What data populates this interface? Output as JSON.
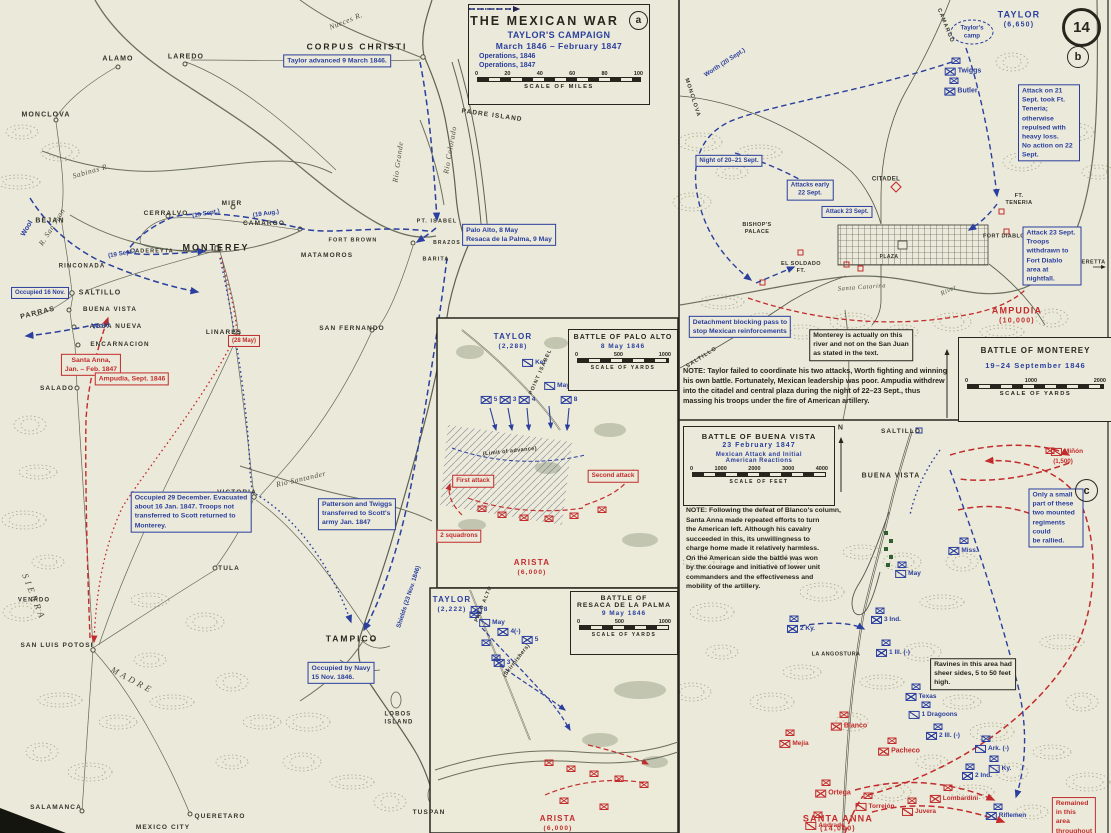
{
  "page": {
    "badge": "14",
    "panel_a_badge": "a",
    "panel_b_badge": "b",
    "panel_c_badge": "c"
  },
  "title_block": {
    "title": "THE MEXICAN WAR",
    "subtitle": "TAYLOR'S CAMPAIGN",
    "dates": "March 1846 – February 1847",
    "legend": [
      {
        "label": "Operations, 1846"
      },
      {
        "label": "Operations, 1847"
      }
    ],
    "scale": {
      "ticks": [
        "0",
        "20",
        "40",
        "60",
        "80",
        "100"
      ],
      "caption": "SCALE OF MILES"
    }
  },
  "battle_boxes": {
    "palo_alto": {
      "title": "BATTLE OF PALO ALTO",
      "date": "8 May 1846",
      "scale": {
        "ticks": [
          "0",
          "500",
          "1000"
        ],
        "caption": "SCALE OF YARDS"
      }
    },
    "resaca": {
      "title": "BATTLE OF\nRESACA DE LA PALMA",
      "date": "9 May 1846",
      "scale": {
        "ticks": [
          "0",
          "500",
          "1000"
        ],
        "caption": "SCALE OF YARDS"
      }
    },
    "monterey": {
      "title": "BATTLE OF MONTEREY",
      "date": "19–24 September 1846",
      "scale": {
        "ticks": [
          "0",
          "1000",
          "2000"
        ],
        "caption": "SCALE OF YARDS"
      }
    },
    "buena_vista": {
      "title": "BATTLE OF BUENA VISTA",
      "date": "23 February 1847",
      "subtitle": "Mexican Attack and Initial\nAmerican Reactions",
      "scale": {
        "ticks": [
          "0",
          "1000",
          "2000",
          "3000",
          "4000"
        ],
        "caption": "SCALE OF FEET"
      }
    }
  },
  "colors": {
    "paper": "#ebe9d9",
    "blue": "#2a3f9e",
    "red": "#c22c2c",
    "ink": "#26261e",
    "terrain": "#a8a58c"
  },
  "labels": [
    {
      "t": "ALAMO",
      "x": 118,
      "y": 60,
      "c": "p",
      "fs": 7
    },
    {
      "t": "LAREDO",
      "x": 186,
      "y": 58,
      "c": "p",
      "fs": 7
    },
    {
      "t": "MONCLOVA",
      "x": 46,
      "y": 116,
      "c": "p",
      "fs": 7
    },
    {
      "t": "BEJAN",
      "x": 50,
      "y": 222,
      "c": "p",
      "fs": 7
    },
    {
      "t": "CERRALVO",
      "x": 166,
      "y": 214,
      "c": "p",
      "fs": 6.5
    },
    {
      "t": "MIER",
      "x": 232,
      "y": 204,
      "c": "p",
      "fs": 6.5
    },
    {
      "t": "CAMARGO",
      "x": 264,
      "y": 224,
      "c": "p",
      "fs": 6.5
    },
    {
      "t": "RINCONADA",
      "x": 82,
      "y": 267,
      "c": "p",
      "fs": 6
    },
    {
      "t": "MONTEREY",
      "x": 216,
      "y": 248,
      "c": "P"
    },
    {
      "t": "SALTILLO",
      "x": 100,
      "y": 294,
      "c": "p",
      "fs": 7
    },
    {
      "t": "BUENA VISTA",
      "x": 110,
      "y": 310,
      "c": "p",
      "fs": 6.3
    },
    {
      "t": "AGUA NUEVA",
      "x": 116,
      "y": 327,
      "c": "p",
      "fs": 6.3
    },
    {
      "t": "ENCARNACION",
      "x": 120,
      "y": 345,
      "c": "p",
      "fs": 6.3
    },
    {
      "t": "PARRAS",
      "x": 38,
      "y": 314,
      "c": "p",
      "fs": 7,
      "r": -14
    },
    {
      "t": "SALADO",
      "x": 57,
      "y": 389,
      "c": "p",
      "fs": 6.5
    },
    {
      "t": "LINARES",
      "x": 224,
      "y": 333,
      "c": "p",
      "fs": 6.5
    },
    {
      "t": "CADEREYTA",
      "x": 152,
      "y": 252,
      "c": "p",
      "fs": 5.5
    },
    {
      "t": "SAN FERNANDO",
      "x": 352,
      "y": 329,
      "c": "p",
      "fs": 6.5
    },
    {
      "t": "VICTORIA",
      "x": 237,
      "y": 493,
      "c": "p",
      "fs": 6.5
    },
    {
      "t": "TULA",
      "x": 229,
      "y": 569,
      "c": "p",
      "fs": 6.5
    },
    {
      "t": "TAMPICO",
      "x": 352,
      "y": 639,
      "c": "P",
      "fs": 8.5
    },
    {
      "t": "SAN LUIS POTOSI",
      "x": 57,
      "y": 646,
      "c": "p",
      "fs": 6.5
    },
    {
      "t": "VENADO",
      "x": 34,
      "y": 601,
      "c": "p",
      "fs": 6
    },
    {
      "t": "SALAMANCA",
      "x": 56,
      "y": 808,
      "c": "p",
      "fs": 6.5
    },
    {
      "t": "QUERETARO",
      "x": 220,
      "y": 817,
      "c": "p",
      "fs": 6.5
    },
    {
      "t": "MEXICO CITY",
      "x": 163,
      "y": 828,
      "c": "p",
      "fs": 6.5
    },
    {
      "t": "LOBOS\nISLAND",
      "x": 399,
      "y": 719,
      "c": "p",
      "fs": 6
    },
    {
      "t": "TUSPAN",
      "x": 429,
      "y": 813,
      "c": "p",
      "fs": 6.5
    },
    {
      "t": "CORPUS CHRISTI",
      "x": 357,
      "y": 47,
      "c": "P",
      "fs": 8.5
    },
    {
      "t": "PADRE ISLAND",
      "x": 492,
      "y": 116,
      "c": "p",
      "fs": 6.5,
      "r": 8
    },
    {
      "t": "PT. ISABEL",
      "x": 437,
      "y": 222,
      "c": "p",
      "fs": 5.5
    },
    {
      "t": "BRAZOS",
      "x": 447,
      "y": 243,
      "c": "p",
      "fs": 5
    },
    {
      "t": "MATAMOROS",
      "x": 327,
      "y": 256,
      "c": "p",
      "fs": 6.5
    },
    {
      "t": "FORT BROWN",
      "x": 353,
      "y": 241,
      "c": "p",
      "fs": 5.5
    },
    {
      "t": "BARITA",
      "x": 436,
      "y": 260,
      "c": "p",
      "fs": 5.5
    },
    {
      "t": "S I E R R A",
      "x": 33,
      "y": 596,
      "c": "rv",
      "fs": 9,
      "r": 68
    },
    {
      "t": "M A D R E",
      "x": 131,
      "y": 680,
      "c": "rv",
      "fs": 9,
      "r": 28
    },
    {
      "t": "Nueces R.",
      "x": 346,
      "y": 21,
      "c": "rv",
      "r": -22
    },
    {
      "t": "Sabinas R.",
      "x": 91,
      "y": 171,
      "c": "rv",
      "r": -16
    },
    {
      "t": "R. San Juan",
      "x": 52,
      "y": 227,
      "c": "rv",
      "r": -58
    },
    {
      "t": "Rio Grande",
      "x": 398,
      "y": 162,
      "c": "rv",
      "r": -82
    },
    {
      "t": "Rio Colorado",
      "x": 450,
      "y": 150,
      "c": "rv",
      "r": -80
    },
    {
      "t": "Rio Santander",
      "x": 301,
      "y": 479,
      "c": "rv",
      "r": -13
    },
    {
      "t": "Santa Catarina",
      "x": 862,
      "y": 288,
      "c": "rv",
      "fs": 6.5,
      "r": -4
    },
    {
      "t": "River",
      "x": 949,
      "y": 291,
      "c": "rv",
      "fs": 6.5,
      "r": -26
    },
    {
      "t": "Wool",
      "x": 28,
      "y": 229,
      "c": "bt",
      "r": -60
    },
    {
      "t": "Wool",
      "x": 101,
      "y": 327,
      "c": "bt",
      "r": -8
    },
    {
      "t": "(15 Sept.)",
      "x": 206,
      "y": 214,
      "c": "bt",
      "fs": 6.2,
      "r": -10
    },
    {
      "t": "(19 Aug.)",
      "x": 266,
      "y": 214,
      "c": "bt",
      "fs": 6.2,
      "r": -8
    },
    {
      "t": "(19 Sept.)",
      "x": 122,
      "y": 254,
      "c": "bt",
      "fs": 6.2,
      "r": -10
    },
    {
      "t": "Shields (23 Nov. 1846)",
      "x": 409,
      "y": 597,
      "c": "bt",
      "fs": 6.2,
      "r": -72
    },
    {
      "t": "Worth (20 Sept.)",
      "x": 725,
      "y": 63,
      "c": "bt",
      "fs": 6.2,
      "r": -33
    },
    {
      "t": "Taylor's\ncamp",
      "x": 972,
      "y": 32,
      "c": "bt",
      "fs": 6.2
    },
    {
      "t": "CAMARGO",
      "x": 945,
      "y": 26,
      "c": "p",
      "fs": 5.5,
      "r": 68
    },
    {
      "t": "MONCLOVA",
      "x": 692,
      "y": 98,
      "c": "p",
      "fs": 5.5,
      "r": 72
    },
    {
      "t": "SALTILLO",
      "x": 702,
      "y": 358,
      "c": "p",
      "fs": 5.5,
      "r": -32
    },
    {
      "t": "TAYLOR",
      "x": 1019,
      "y": 15,
      "c": "bB"
    },
    {
      "t": "(6,650)",
      "x": 1019,
      "y": 26,
      "c": "bB",
      "fs": 7
    },
    {
      "t": "TAYLOR",
      "x": 513,
      "y": 337,
      "c": "bB",
      "fs": 8
    },
    {
      "t": "(2,288)",
      "x": 513,
      "y": 347,
      "c": "bB",
      "fs": 6.5
    },
    {
      "t": "TAYLOR",
      "x": 452,
      "y": 600,
      "c": "bB",
      "fs": 8
    },
    {
      "t": "(2,222)",
      "x": 452,
      "y": 610,
      "c": "bB",
      "fs": 6.5
    },
    {
      "t": "AMPUDIA",
      "x": 1017,
      "y": 311,
      "c": "rB"
    },
    {
      "t": "(10,000)",
      "x": 1017,
      "y": 322,
      "c": "rB",
      "fs": 7
    },
    {
      "t": "ARISTA",
      "x": 532,
      "y": 563,
      "c": "rB",
      "fs": 8
    },
    {
      "t": "(6,000)",
      "x": 532,
      "y": 573,
      "c": "rB",
      "fs": 6.5
    },
    {
      "t": "ARISTA",
      "x": 558,
      "y": 819,
      "c": "rB",
      "fs": 8
    },
    {
      "t": "(6,000)",
      "x": 558,
      "y": 829,
      "c": "rB",
      "fs": 6.5
    },
    {
      "t": "SANTA ANNA",
      "x": 838,
      "y": 819,
      "c": "rB"
    },
    {
      "t": "(14,000)",
      "x": 838,
      "y": 830,
      "c": "rB",
      "fs": 7
    },
    {
      "t": "CITADEL",
      "x": 886,
      "y": 180,
      "c": "tiny"
    },
    {
      "t": "BISHOP'S\nPALACE",
      "x": 757,
      "y": 229,
      "c": "tiny",
      "fs": 5.5
    },
    {
      "t": "EL SOLDADO\nFT.",
      "x": 801,
      "y": 268,
      "c": "tiny",
      "fs": 5.5
    },
    {
      "t": "FT.\nTENERIA",
      "x": 1019,
      "y": 200,
      "c": "tiny",
      "fs": 5.5
    },
    {
      "t": "FORT DIABLO",
      "x": 1004,
      "y": 237,
      "c": "tiny",
      "fs": 5.5
    },
    {
      "t": "PLAZA",
      "x": 889,
      "y": 257,
      "c": "tiny",
      "fs": 5
    },
    {
      "t": "CADERETTA",
      "x": 1087,
      "y": 263,
      "c": "tiny",
      "fs": 5.5
    },
    {
      "t": "SALTILLO",
      "x": 901,
      "y": 432,
      "c": "p",
      "fs": 6.5
    },
    {
      "t": "BUENA VISTA",
      "x": 891,
      "y": 477,
      "c": "p",
      "fs": 7
    },
    {
      "t": "LA ANGOSTURA",
      "x": 836,
      "y": 655,
      "c": "tiny",
      "fs": 5.5
    },
    {
      "t": "N",
      "x": 841,
      "y": 429,
      "c": "p",
      "fs": 7
    },
    {
      "t": "Taylor advanced 9 March 1846.",
      "x": 337,
      "y": 61,
      "c": "bb"
    },
    {
      "t": "Palo Alto, 8 May\nResaca de la Palma, 9 May",
      "x": 509,
      "y": 235,
      "c": "bb",
      "a": "left"
    },
    {
      "t": "Occupied 16 Nov.",
      "x": 40,
      "y": 293,
      "c": "bb",
      "fs": 6
    },
    {
      "t": "Occupied 29 December. Evacuated\nabout 16 Jan. 1847. Troops not\ntransferred to Scott returned to\nMonterey.",
      "x": 191,
      "y": 512,
      "c": "bb",
      "a": "left"
    },
    {
      "t": "Patterson and Twiggs\ntransferred to Scott's\narmy Jan. 1847",
      "x": 357,
      "y": 514,
      "c": "bb",
      "a": "left"
    },
    {
      "t": "Occupied by Navy\n15 Nov. 1846.",
      "x": 341,
      "y": 673,
      "c": "bb",
      "a": "left"
    },
    {
      "t": "Night of 20–21 Sept.",
      "x": 729,
      "y": 161,
      "c": "bb",
      "fs": 6.2
    },
    {
      "t": "Attacks early\n22 Sept.",
      "x": 810,
      "y": 190,
      "c": "bb",
      "fs": 6.2
    },
    {
      "t": "Attack 23 Sept.",
      "x": 847,
      "y": 212,
      "c": "bb",
      "fs": 6
    },
    {
      "t": "Attack on 21 Sept. took Ft. Teneria;\notherwise repulsed with heavy loss.\nNo action on 22 Sept.",
      "x": 1049,
      "y": 123,
      "c": "bb",
      "a": "left"
    },
    {
      "t": "Attack 23 Sept. Troops\nwithdrawn to Fort Diablo\narea at nightfall.",
      "x": 1052,
      "y": 256,
      "c": "bb",
      "a": "left"
    },
    {
      "t": "Detachment blocking pass to\nstop Mexican reinforcements",
      "x": 740,
      "y": 327,
      "c": "bb",
      "a": "left"
    },
    {
      "t": "Only a small part of these\ntwo mounted regiments could\nbe rallied.",
      "x": 1056,
      "y": 518,
      "c": "bb",
      "a": "left"
    },
    {
      "t": "Santa Anna,\nJan. – Feb. 1847",
      "x": 91,
      "y": 365,
      "c": "rb"
    },
    {
      "t": "Ampudia, Sept. 1846",
      "x": 132,
      "y": 379,
      "c": "rb"
    },
    {
      "t": "(28 May)",
      "x": 244,
      "y": 341,
      "c": "rb",
      "fs": 6
    },
    {
      "t": "First attack",
      "x": 473,
      "y": 481,
      "c": "rb",
      "fs": 6.3
    },
    {
      "t": "Second attack",
      "x": 613,
      "y": 476,
      "c": "rb",
      "fs": 6.3
    },
    {
      "t": "2 squadrons",
      "x": 459,
      "y": 536,
      "c": "rb",
      "fs": 6.3
    },
    {
      "t": "Remained in this\narea throughout\nbattle.",
      "x": 1074,
      "y": 822,
      "c": "rb",
      "a": "left"
    },
    {
      "t": "Monterey is actually on this\nriver and not on the San Juan\nas stated in the text.",
      "x": 861,
      "y": 345,
      "c": "kb",
      "a": "left"
    },
    {
      "t": "Ravines in this area had\nsheer sides, 5 to 50 feet\nhigh.",
      "x": 973,
      "y": 674,
      "c": "kb",
      "a": "left"
    },
    {
      "t": "NOTE: Taylor failed to coordinate his two attacks, Worth fighting and winning his own battle. Fortunately, Mexican leadership was poor. Ampudia withdrew into the citadel and central plaza during the night of 22–23 Sept., thus massing his troops under the fire of American artillery.",
      "x": 683,
      "y": 366,
      "c": "nt",
      "anchor": "tl",
      "w": 268
    },
    {
      "t": "NOTE: Following the defeat of Blanco's column,\nSanta Anna made repeated efforts to turn\nthe American left. Although his cavalry\nsucceeded in this, its unwillingness to\ncharge home made it relatively harmless.\nOn the American side the battle was won\nby the courage and initiative of lower unit\ncommanders and the effectiveness and\nmobility of the artillery.",
      "x": 686,
      "y": 506,
      "c": "nt",
      "anchor": "tl",
      "w": 176,
      "fs": 6.8
    },
    {
      "t": "Twiggs",
      "x": 963,
      "y": 72,
      "c": "bu"
    },
    {
      "t": "Butler",
      "x": 961,
      "y": 92,
      "c": "bu"
    },
    {
      "t": "Ker",
      "x": 534,
      "y": 363,
      "c": "bc",
      "fs": 6.5
    },
    {
      "t": "May",
      "x": 557,
      "y": 386,
      "c": "bc",
      "fs": 6.5
    },
    {
      "t": "5",
      "x": 489,
      "y": 400,
      "c": "bu",
      "fs": 6.5
    },
    {
      "t": "3",
      "x": 508,
      "y": 400,
      "c": "bu",
      "fs": 6.5
    },
    {
      "t": "4",
      "x": 527,
      "y": 400,
      "c": "bu",
      "fs": 6.5
    },
    {
      "t": "8",
      "x": 569,
      "y": 400,
      "c": "bu",
      "fs": 6.5
    },
    {
      "t": "8",
      "x": 479,
      "y": 610,
      "c": "bu",
      "fs": 6.5
    },
    {
      "t": "May",
      "x": 492,
      "y": 623,
      "c": "bc",
      "fs": 6.5
    },
    {
      "t": "4(-)",
      "x": 509,
      "y": 632,
      "c": "bu",
      "fs": 6.5
    },
    {
      "t": "5",
      "x": 530,
      "y": 640,
      "c": "bu",
      "fs": 6.5
    },
    {
      "t": "3",
      "x": 502,
      "y": 663,
      "c": "bu",
      "fs": 6.5
    },
    {
      "t": "(Skirmishers)",
      "x": 517,
      "y": 661,
      "c": "tiny",
      "fs": 5.5,
      "r": -52
    },
    {
      "t": "(Limit of advance)",
      "x": 510,
      "y": 452,
      "c": "tiny",
      "fs": 5.5,
      "r": -6
    },
    {
      "t": "POINT ISABEL",
      "x": 541,
      "y": 372,
      "c": "p",
      "fs": 5.2,
      "r": -66
    },
    {
      "t": "PALO ALTO",
      "x": 484,
      "y": 604,
      "c": "p",
      "fs": 5.2,
      "r": -68
    },
    {
      "t": "Miss.",
      "x": 963,
      "y": 551,
      "c": "bu",
      "fs": 6.5
    },
    {
      "t": "May",
      "x": 908,
      "y": 574,
      "c": "bc",
      "fs": 6.5
    },
    {
      "t": "3 Ind.",
      "x": 886,
      "y": 620,
      "c": "bu",
      "fs": 6.5
    },
    {
      "t": "2 Ky.",
      "x": 801,
      "y": 629,
      "c": "bu",
      "fs": 6.5
    },
    {
      "t": "1 Ill. (-)",
      "x": 893,
      "y": 653,
      "c": "bu",
      "fs": 6.5
    },
    {
      "t": "Texas",
      "x": 921,
      "y": 697,
      "c": "bu",
      "fs": 6.5
    },
    {
      "t": "1 Dragoons",
      "x": 933,
      "y": 715,
      "c": "bc",
      "fs": 6.5
    },
    {
      "t": "2 Ill. (-)",
      "x": 943,
      "y": 736,
      "c": "bu",
      "fs": 6.5
    },
    {
      "t": "Ark. (-)",
      "x": 992,
      "y": 749,
      "c": "bc",
      "fs": 6.5
    },
    {
      "t": "Ky.",
      "x": 1000,
      "y": 769,
      "c": "bc",
      "fs": 6.5
    },
    {
      "t": "2 Ind.",
      "x": 977,
      "y": 776,
      "c": "bu",
      "fs": 6.5
    },
    {
      "t": "Riflemen",
      "x": 1006,
      "y": 816,
      "c": "bu",
      "fs": 6.5
    },
    {
      "t": "Miñón",
      "x": 1067,
      "y": 452,
      "c": "rc",
      "fs": 6.5
    },
    {
      "t": "(1,500)",
      "x": 1063,
      "y": 462,
      "c": "rt",
      "fs": 6.2
    },
    {
      "t": "Mejia",
      "x": 794,
      "y": 744,
      "c": "ru",
      "fs": 6.5
    },
    {
      "t": "Blanco",
      "x": 849,
      "y": 727,
      "c": "ru"
    },
    {
      "t": "Pacheco",
      "x": 899,
      "y": 752,
      "c": "ru"
    },
    {
      "t": "Ortega",
      "x": 833,
      "y": 794,
      "c": "ru"
    },
    {
      "t": "Torrejón",
      "x": 875,
      "y": 807,
      "c": "rc",
      "fs": 6.5
    },
    {
      "t": "Juvera",
      "x": 919,
      "y": 812,
      "c": "rc",
      "fs": 6.5
    },
    {
      "t": "Lombardini",
      "x": 954,
      "y": 799,
      "c": "ru",
      "fs": 6.5
    },
    {
      "t": "Andrade",
      "x": 825,
      "y": 826,
      "c": "rc",
      "fs": 6.5
    }
  ]
}
